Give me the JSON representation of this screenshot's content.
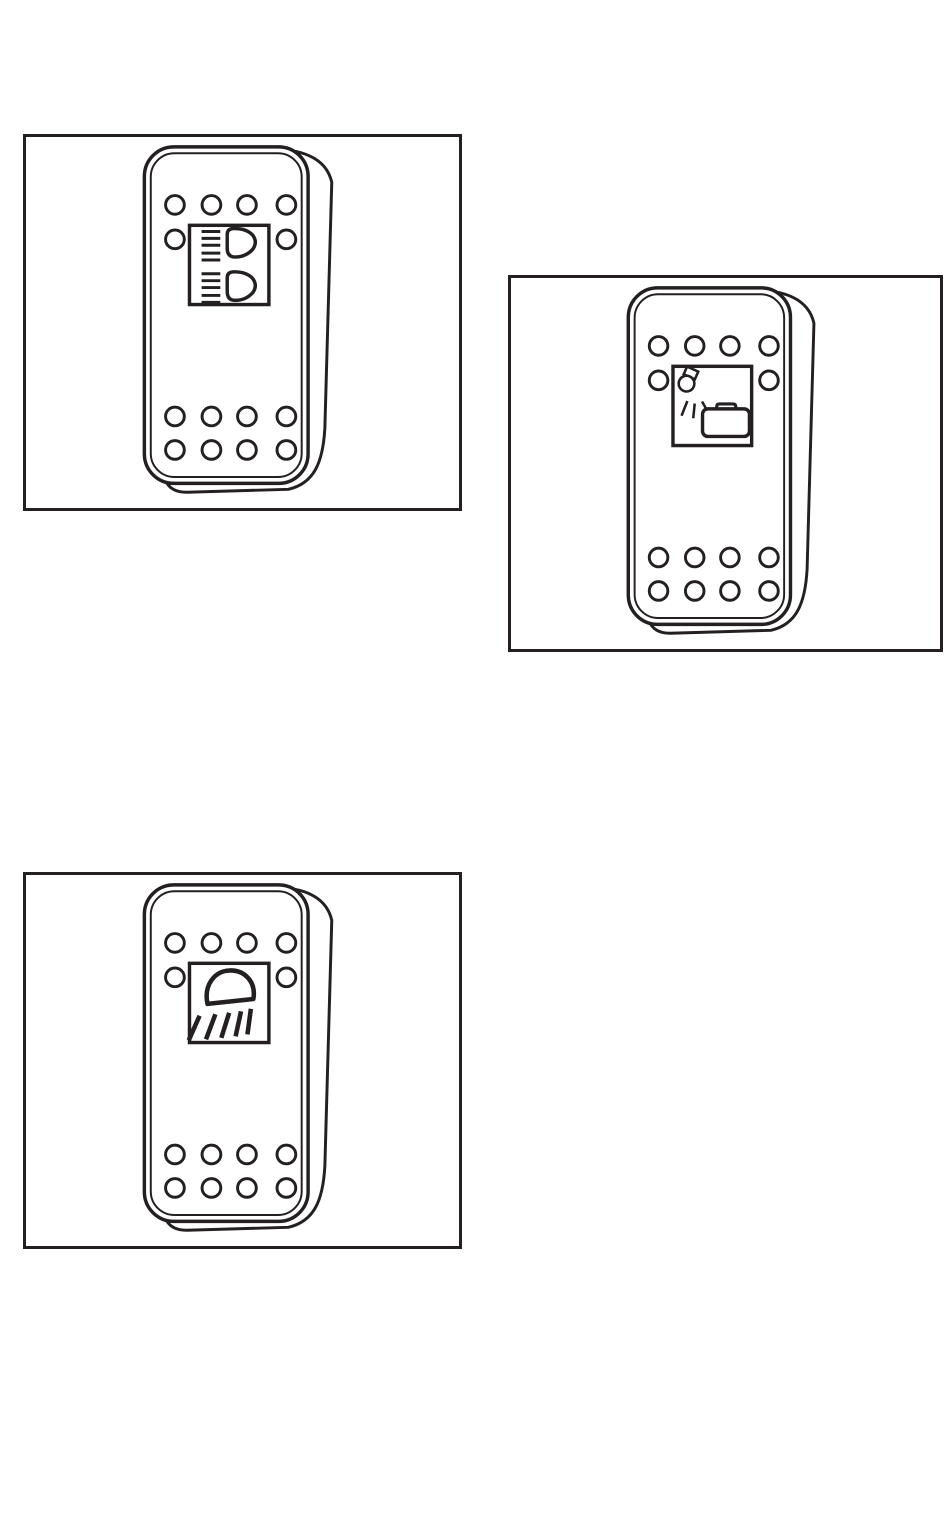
{
  "page": {
    "background": "#ffffff",
    "ink_color": "#242021",
    "kind": "manual-figures-page"
  },
  "switch_template": {
    "indicator_circles": {
      "top_row": 4,
      "middle_row": 2,
      "bottom_row_1": 4,
      "bottom_row_2": 4
    }
  },
  "figures": [
    {
      "name": "rocker-switch-headlight-high-low-beam",
      "icon": "headlight-high-low-beam-icon",
      "position": "top-left"
    },
    {
      "name": "rocker-switch-cargo-work-lamp",
      "icon": "lamp-shining-on-cargo-box-icon",
      "position": "middle-right"
    },
    {
      "name": "rocker-switch-work-lamp",
      "icon": "work-lamp-with-beams-icon",
      "position": "bottom-left"
    }
  ]
}
